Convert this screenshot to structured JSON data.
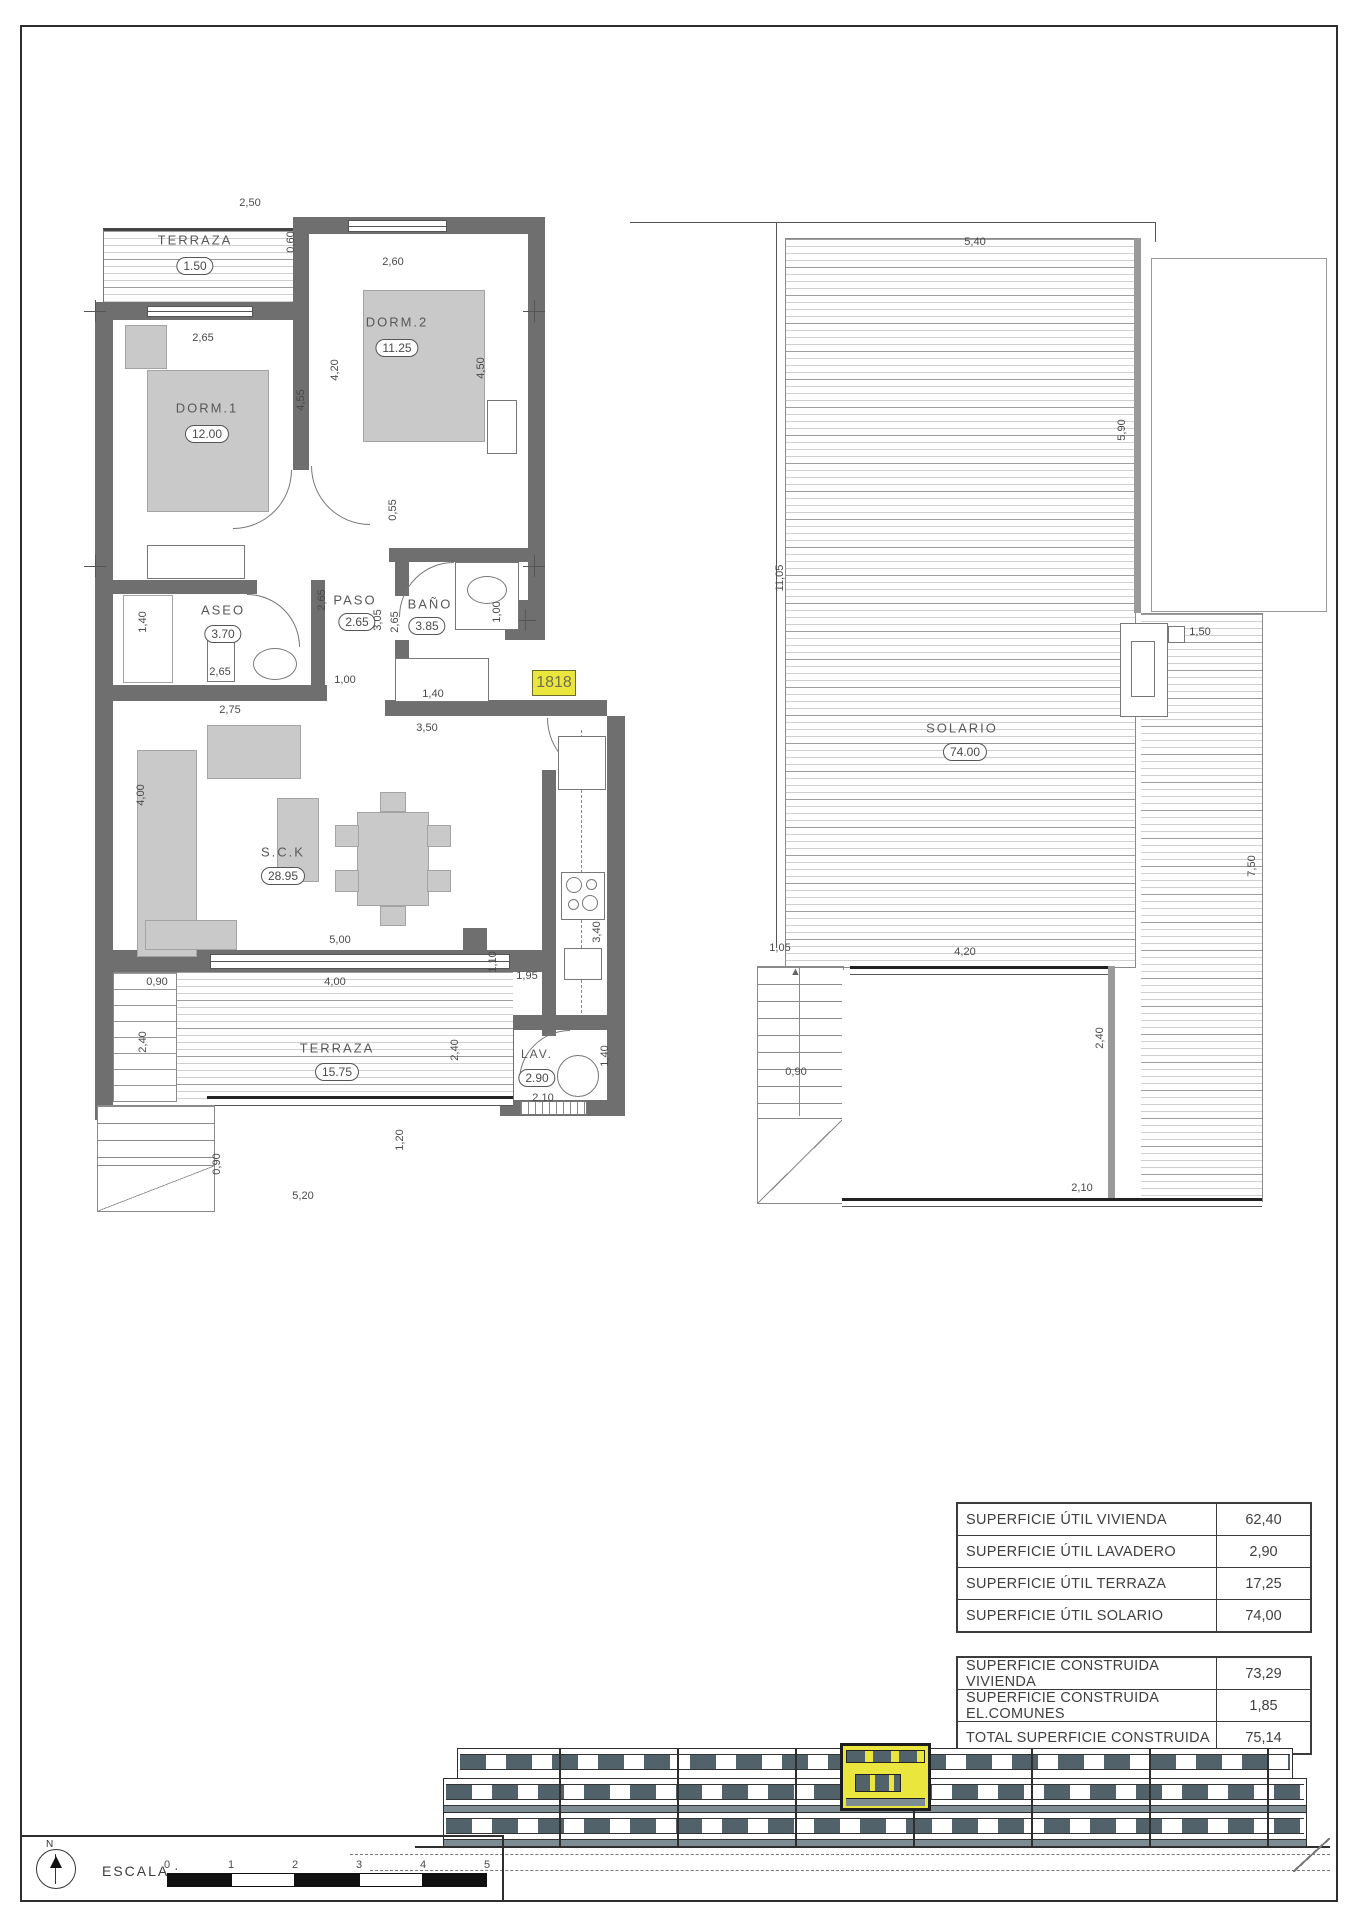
{
  "unit_badge": "1818",
  "floor_plan": {
    "rooms": [
      {
        "name": "TERRAZA",
        "area": "1.50"
      },
      {
        "name": "DORM.1",
        "area": "12.00"
      },
      {
        "name": "DORM.2",
        "area": "11.25"
      },
      {
        "name": "ASEO",
        "area": "3.70"
      },
      {
        "name": "PASO",
        "area": "2.65"
      },
      {
        "name": "BAÑO",
        "area": "3.85"
      },
      {
        "name": "S.C.K",
        "area": "28.95"
      },
      {
        "name": "TERRAZA",
        "area": "15.75"
      },
      {
        "name": "LAV.",
        "area": "2.90"
      }
    ],
    "dims": [
      "2,50",
      "0,60",
      "2,65",
      "2,60",
      "4,55",
      "4,20",
      "4,50",
      "0,55",
      "1,40",
      "2,65",
      "2,75",
      "2,65",
      "3,05",
      "2,65",
      "1,00",
      "1,40",
      "3,50",
      "1,00",
      "4,00",
      "5,00",
      "4,00",
      "1,10",
      "0,90",
      "1,95",
      "3,40",
      "2,40",
      "2,40",
      "0,90",
      "5,20",
      "1,20",
      "2,10",
      "1,40"
    ]
  },
  "roof_plan": {
    "room": {
      "name": "SOLARIO",
      "area": "74.00"
    },
    "dims": [
      "5,40",
      "11,05",
      "5,90",
      "1,50",
      "7,50",
      "1,05",
      "4,20",
      "0,90",
      "2,40",
      "2,10"
    ]
  },
  "areas_table": {
    "util": {
      "rows": [
        [
          "SUPERFICIE ÚTIL VIVIENDA",
          "62,40"
        ],
        [
          "SUPERFICIE ÚTIL LAVADERO",
          "2,90"
        ],
        [
          "SUPERFICIE ÚTIL TERRAZA",
          "17,25"
        ],
        [
          "SUPERFICIE ÚTIL SOLARIO",
          "74,00"
        ]
      ]
    },
    "construida": {
      "rows": [
        [
          "SUPERFICIE CONSTRUIDA VIVIENDA",
          "73,29"
        ],
        [
          "SUPERFICIE CONSTRUIDA EL.COMUNES",
          "1,85"
        ],
        [
          "TOTAL SUPERFICIE CONSTRUIDA",
          "75,14"
        ]
      ]
    }
  },
  "title_block": {
    "north_label": "N",
    "scale_label": "ESCALA :",
    "scale_ticks": [
      "0",
      "1",
      "2",
      "3",
      "4",
      "5"
    ]
  },
  "colors": {
    "highlight": "#ebe63e",
    "wall": "#6f6f6f",
    "furniture": "#c9c9c9",
    "window_band": "#51626a"
  }
}
